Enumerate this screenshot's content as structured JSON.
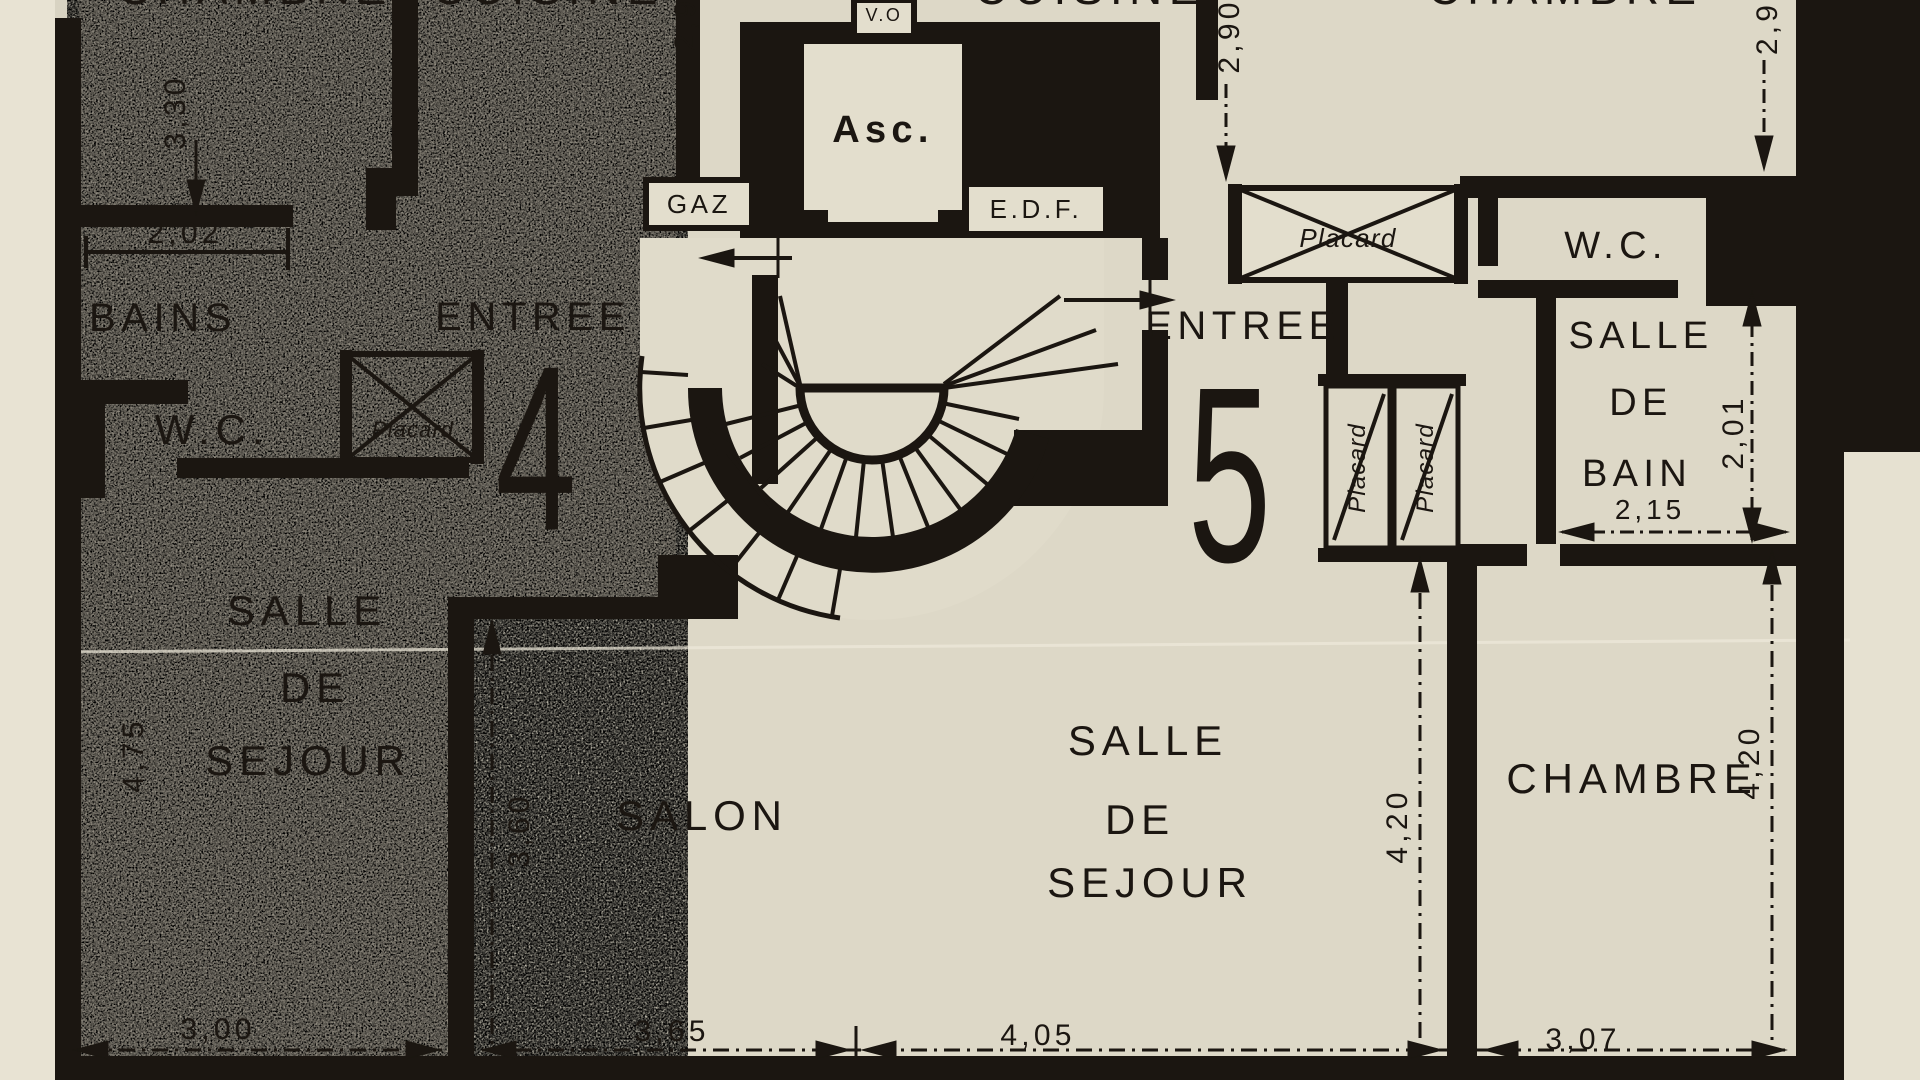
{
  "plan": {
    "core": {
      "elevator": "Asc.",
      "gas_meter": "GAZ",
      "electric_meter": "E.D.F.",
      "garbage_chute": "V.O"
    },
    "apartment_4": {
      "number": "4",
      "entry": "ENTREE",
      "chambre_top": "CHAMBRE",
      "cuisine_top": "CUISINE",
      "bains": "BAINS",
      "wc": "W.C.",
      "placard": "Placard",
      "sejour": {
        "l1": "SALLE",
        "l2": "DE",
        "l3": "SEJOUR"
      },
      "salon": "SALON",
      "dims": {
        "chambre_height": "3,30",
        "bains_width": "2,02",
        "cuisine_height": "2,9",
        "sejour_height": "4,75",
        "sejour_width": "3,00",
        "salon_height": "3,60",
        "salon_width": "3,65"
      }
    },
    "apartment_5": {
      "number": "5",
      "entry": "ENTREE",
      "cuisine_top": "CUISINE",
      "chambre_top": "CHAMBRE",
      "placard_hall": "Placard",
      "placard_left": "Placard",
      "placard_right": "Placard",
      "wc": "W.C.",
      "salle_de_bain": {
        "l1": "SALLE",
        "l2": "DE",
        "l3": "BAIN"
      },
      "sejour": {
        "l1": "SALLE",
        "l2": "DE",
        "l3": "SEJOUR"
      },
      "chambre": "CHAMBRE",
      "dims": {
        "cuisine_height": "2,90",
        "chambre_top_height": "2,9",
        "bain_height": "2,01",
        "bain_width": "2,15",
        "sejour_height": "4,20",
        "chambre_height": "4,20",
        "sejour_width": "4,05",
        "chambre_width": "3,07"
      }
    },
    "colors": {
      "paper": "#d8d3c2",
      "ink": "#1b1611",
      "apartment4_fill": "#a7a194",
      "room_fill": "#ddd8c7"
    }
  }
}
